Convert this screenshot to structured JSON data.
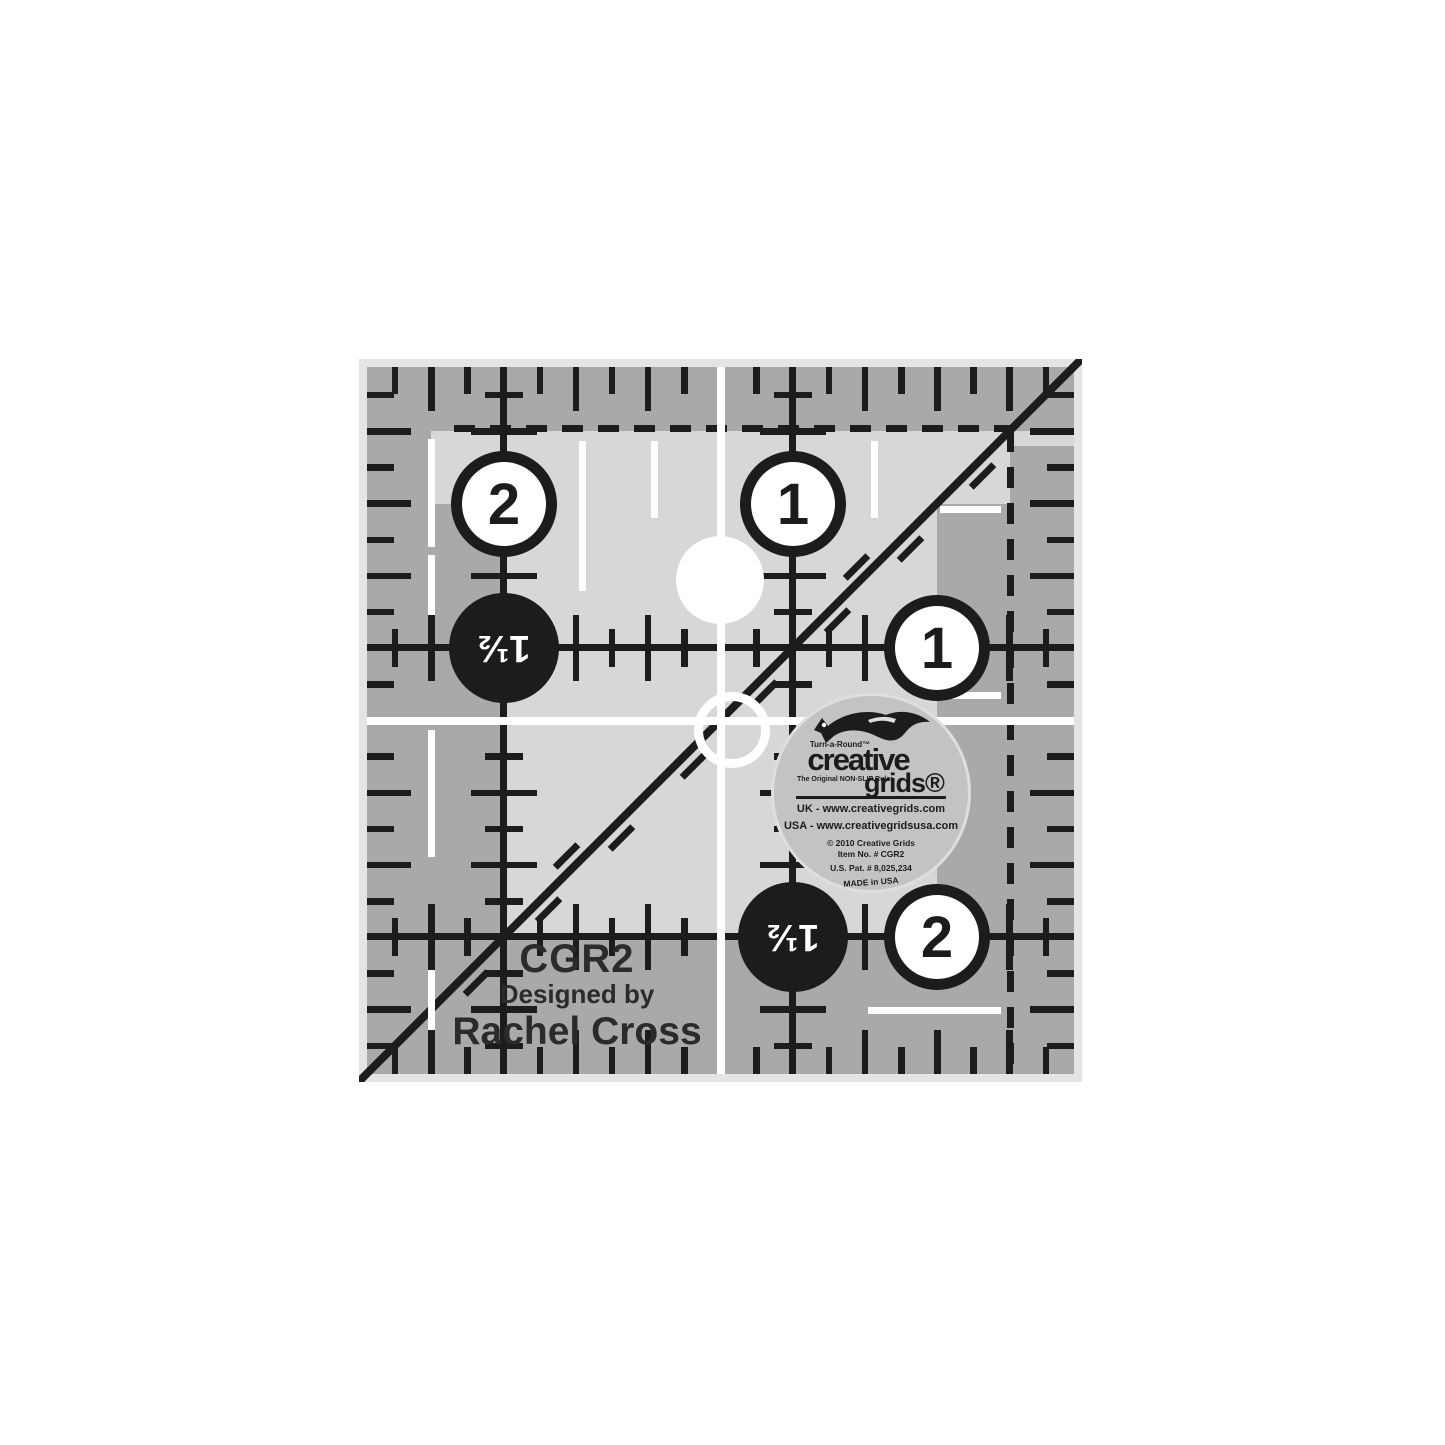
{
  "product": {
    "model": "CGR2",
    "designed_by_label": "Designed by",
    "designer": "Rachel Cross"
  },
  "badges": {
    "top_left": "2",
    "top": "1",
    "right": "1",
    "bottom_right": "2",
    "left_half": "1½",
    "bottom_half": "1½"
  },
  "sticker": {
    "brand_top": "Turn-a-Round™",
    "brand_main": "creative",
    "brand_sub": "grids®",
    "tagline": "The Original NON-SLIP Ruler",
    "uk_line": "UK - www.creativegrids.com",
    "usa_line": "USA - www.creativegridsusa.com",
    "copyright_line": "© 2010 Creative Grids",
    "item_line": "Item No. # CGR2",
    "patent_line": "U.S. Pat. # 8,025,234",
    "made_line": "MADE in USA"
  },
  "icons": {
    "fox_logo": "leaping-fox-silhouette"
  },
  "colors": {
    "ruler_dark": "#a9a9a9",
    "ruler_light": "#d7d7d7",
    "bevel": "#e4e4e4",
    "ink": "#1c1c1c",
    "white": "#ffffff",
    "sticker_bg": "#c3c3c3",
    "text_dark": "#2b2b2b",
    "page_bg": "#ffffff"
  }
}
